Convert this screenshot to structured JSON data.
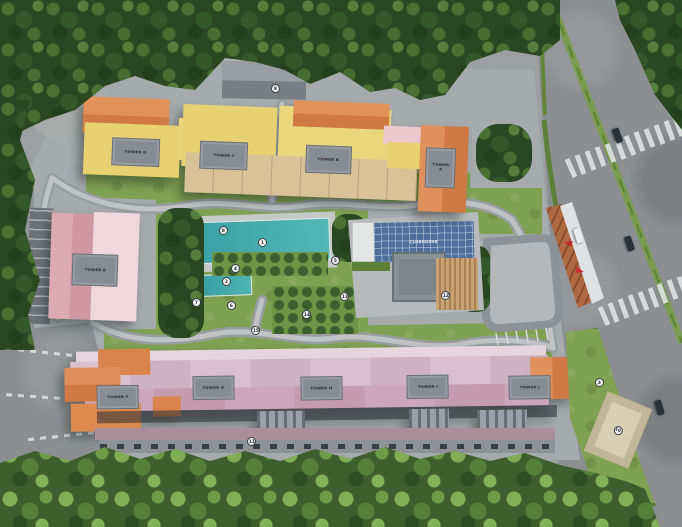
{
  "site": {
    "towers": {
      "top": [
        {
          "label": "TOWER D"
        },
        {
          "label": "TOWER C"
        },
        {
          "label": "TOWER B"
        },
        {
          "label": "TOWER A"
        }
      ],
      "west": [
        {
          "label": "TOWER E"
        }
      ],
      "bottom": [
        {
          "label": "TOWER F"
        },
        {
          "label": "TOWER G"
        },
        {
          "label": "TOWER H"
        },
        {
          "label": "TOWER I"
        },
        {
          "label": "TOWER J"
        }
      ]
    },
    "clubhouse": {
      "label": "CLUBHOUSE"
    },
    "markers": [
      {
        "n": "1"
      },
      {
        "n": "2"
      },
      {
        "n": "3"
      },
      {
        "n": "4"
      },
      {
        "n": "5"
      },
      {
        "n": "6"
      },
      {
        "n": "7"
      },
      {
        "n": "8"
      },
      {
        "n": "9"
      },
      {
        "n": "10"
      },
      {
        "n": "11"
      },
      {
        "n": "12"
      },
      {
        "n": "13"
      },
      {
        "n": "14"
      },
      {
        "n": "15"
      }
    ],
    "colors": {
      "pool": "#45b0b0",
      "roof_orange": "#d9834d",
      "roof_yellow": "#e7d170",
      "roof_pink_light": "#eed8dd",
      "roof_rose": "#d7a2ab",
      "roof_mauve": "#d5bac9",
      "roof_tan": "#d9c297",
      "solar_roof": "#4e6f9c",
      "entry_wall": "#b06a42",
      "arrow_red": "#c8272b",
      "tree_dark": "#2b4722",
      "lawn": "#7fa152"
    }
  }
}
